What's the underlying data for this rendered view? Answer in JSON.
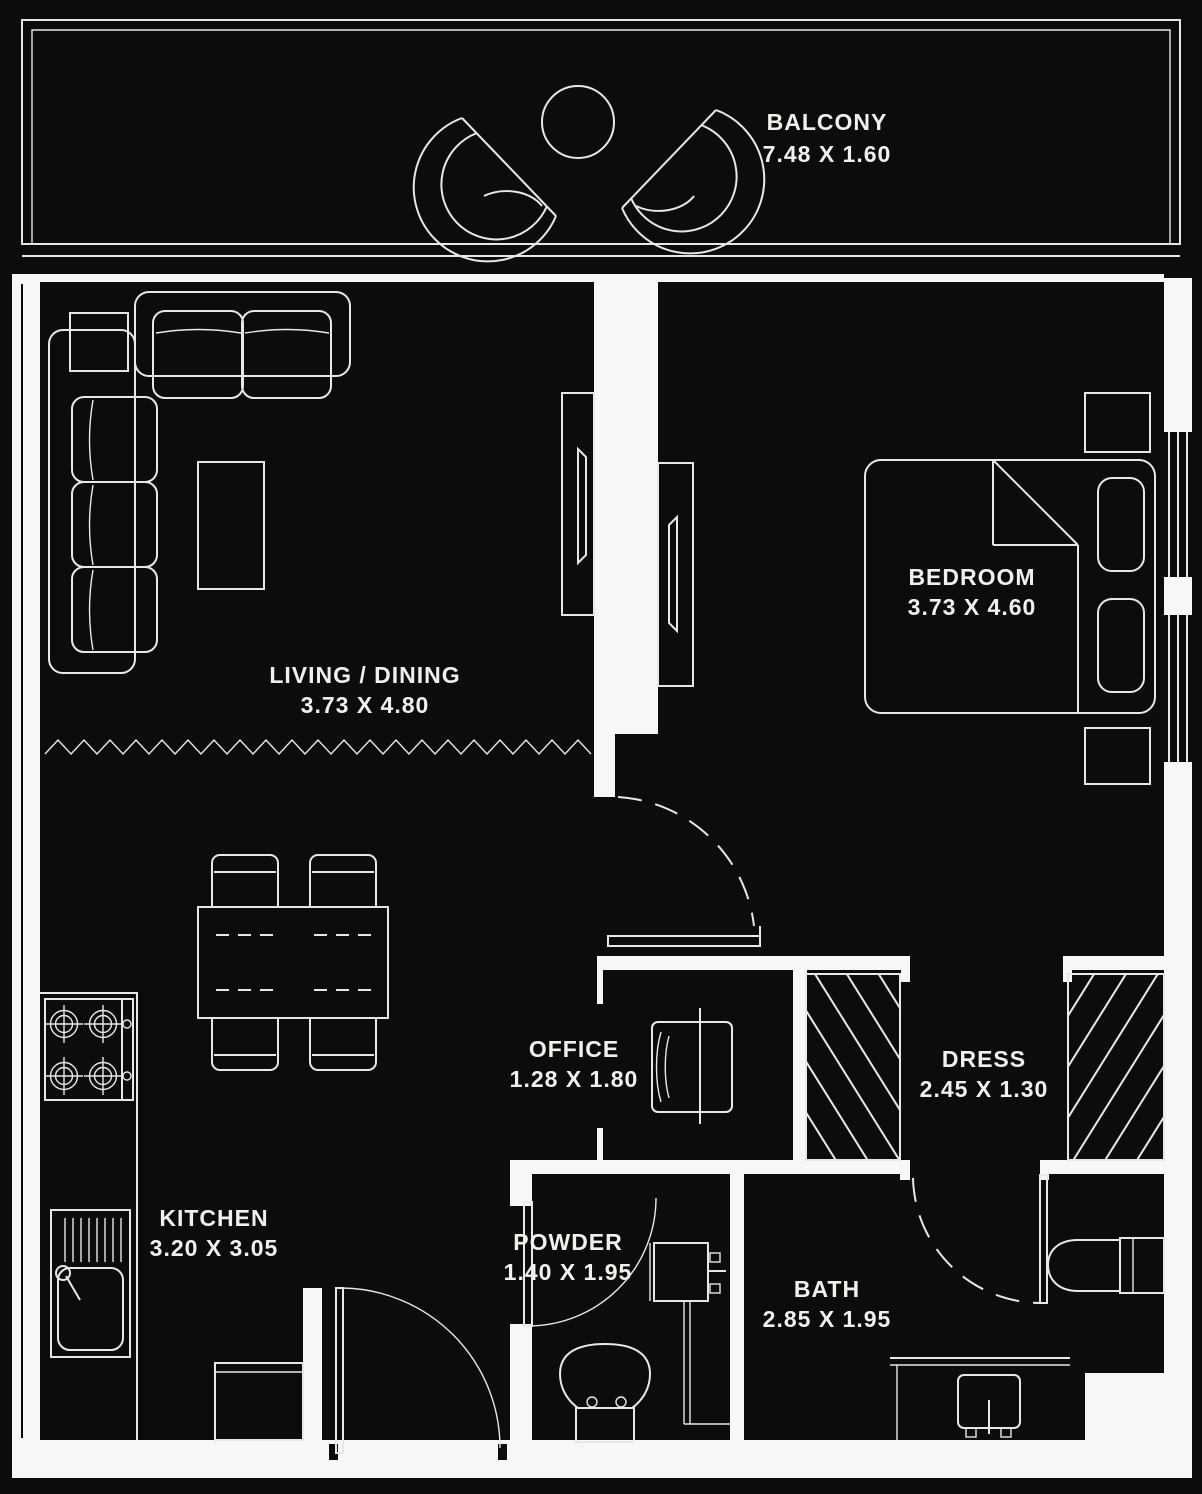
{
  "plan": {
    "colors": {
      "bg": "#0e0c0a",
      "line": "#e9e8e5",
      "wall": "#f8f7f5",
      "text": "#f1f0ed"
    }
  },
  "rooms": {
    "balcony": {
      "name": "BALCONY",
      "dims": "7.48 X 1.60"
    },
    "living_dining": {
      "name": "LIVING / DINING",
      "dims": "3.73 X 4.80"
    },
    "bedroom": {
      "name": "BEDROOM",
      "dims": "3.73 X 4.60"
    },
    "office": {
      "name": "OFFICE",
      "dims": "1.28 X 1.80"
    },
    "dress": {
      "name": "DRESS",
      "dims": "2.45 X 1.30"
    },
    "kitchen": {
      "name": "KITCHEN",
      "dims": "3.20 X 3.05"
    },
    "powder": {
      "name": "POWDER",
      "dims": "1.40 X 1.95"
    },
    "bath": {
      "name": "BATH",
      "dims": "2.85 X 1.95"
    }
  }
}
